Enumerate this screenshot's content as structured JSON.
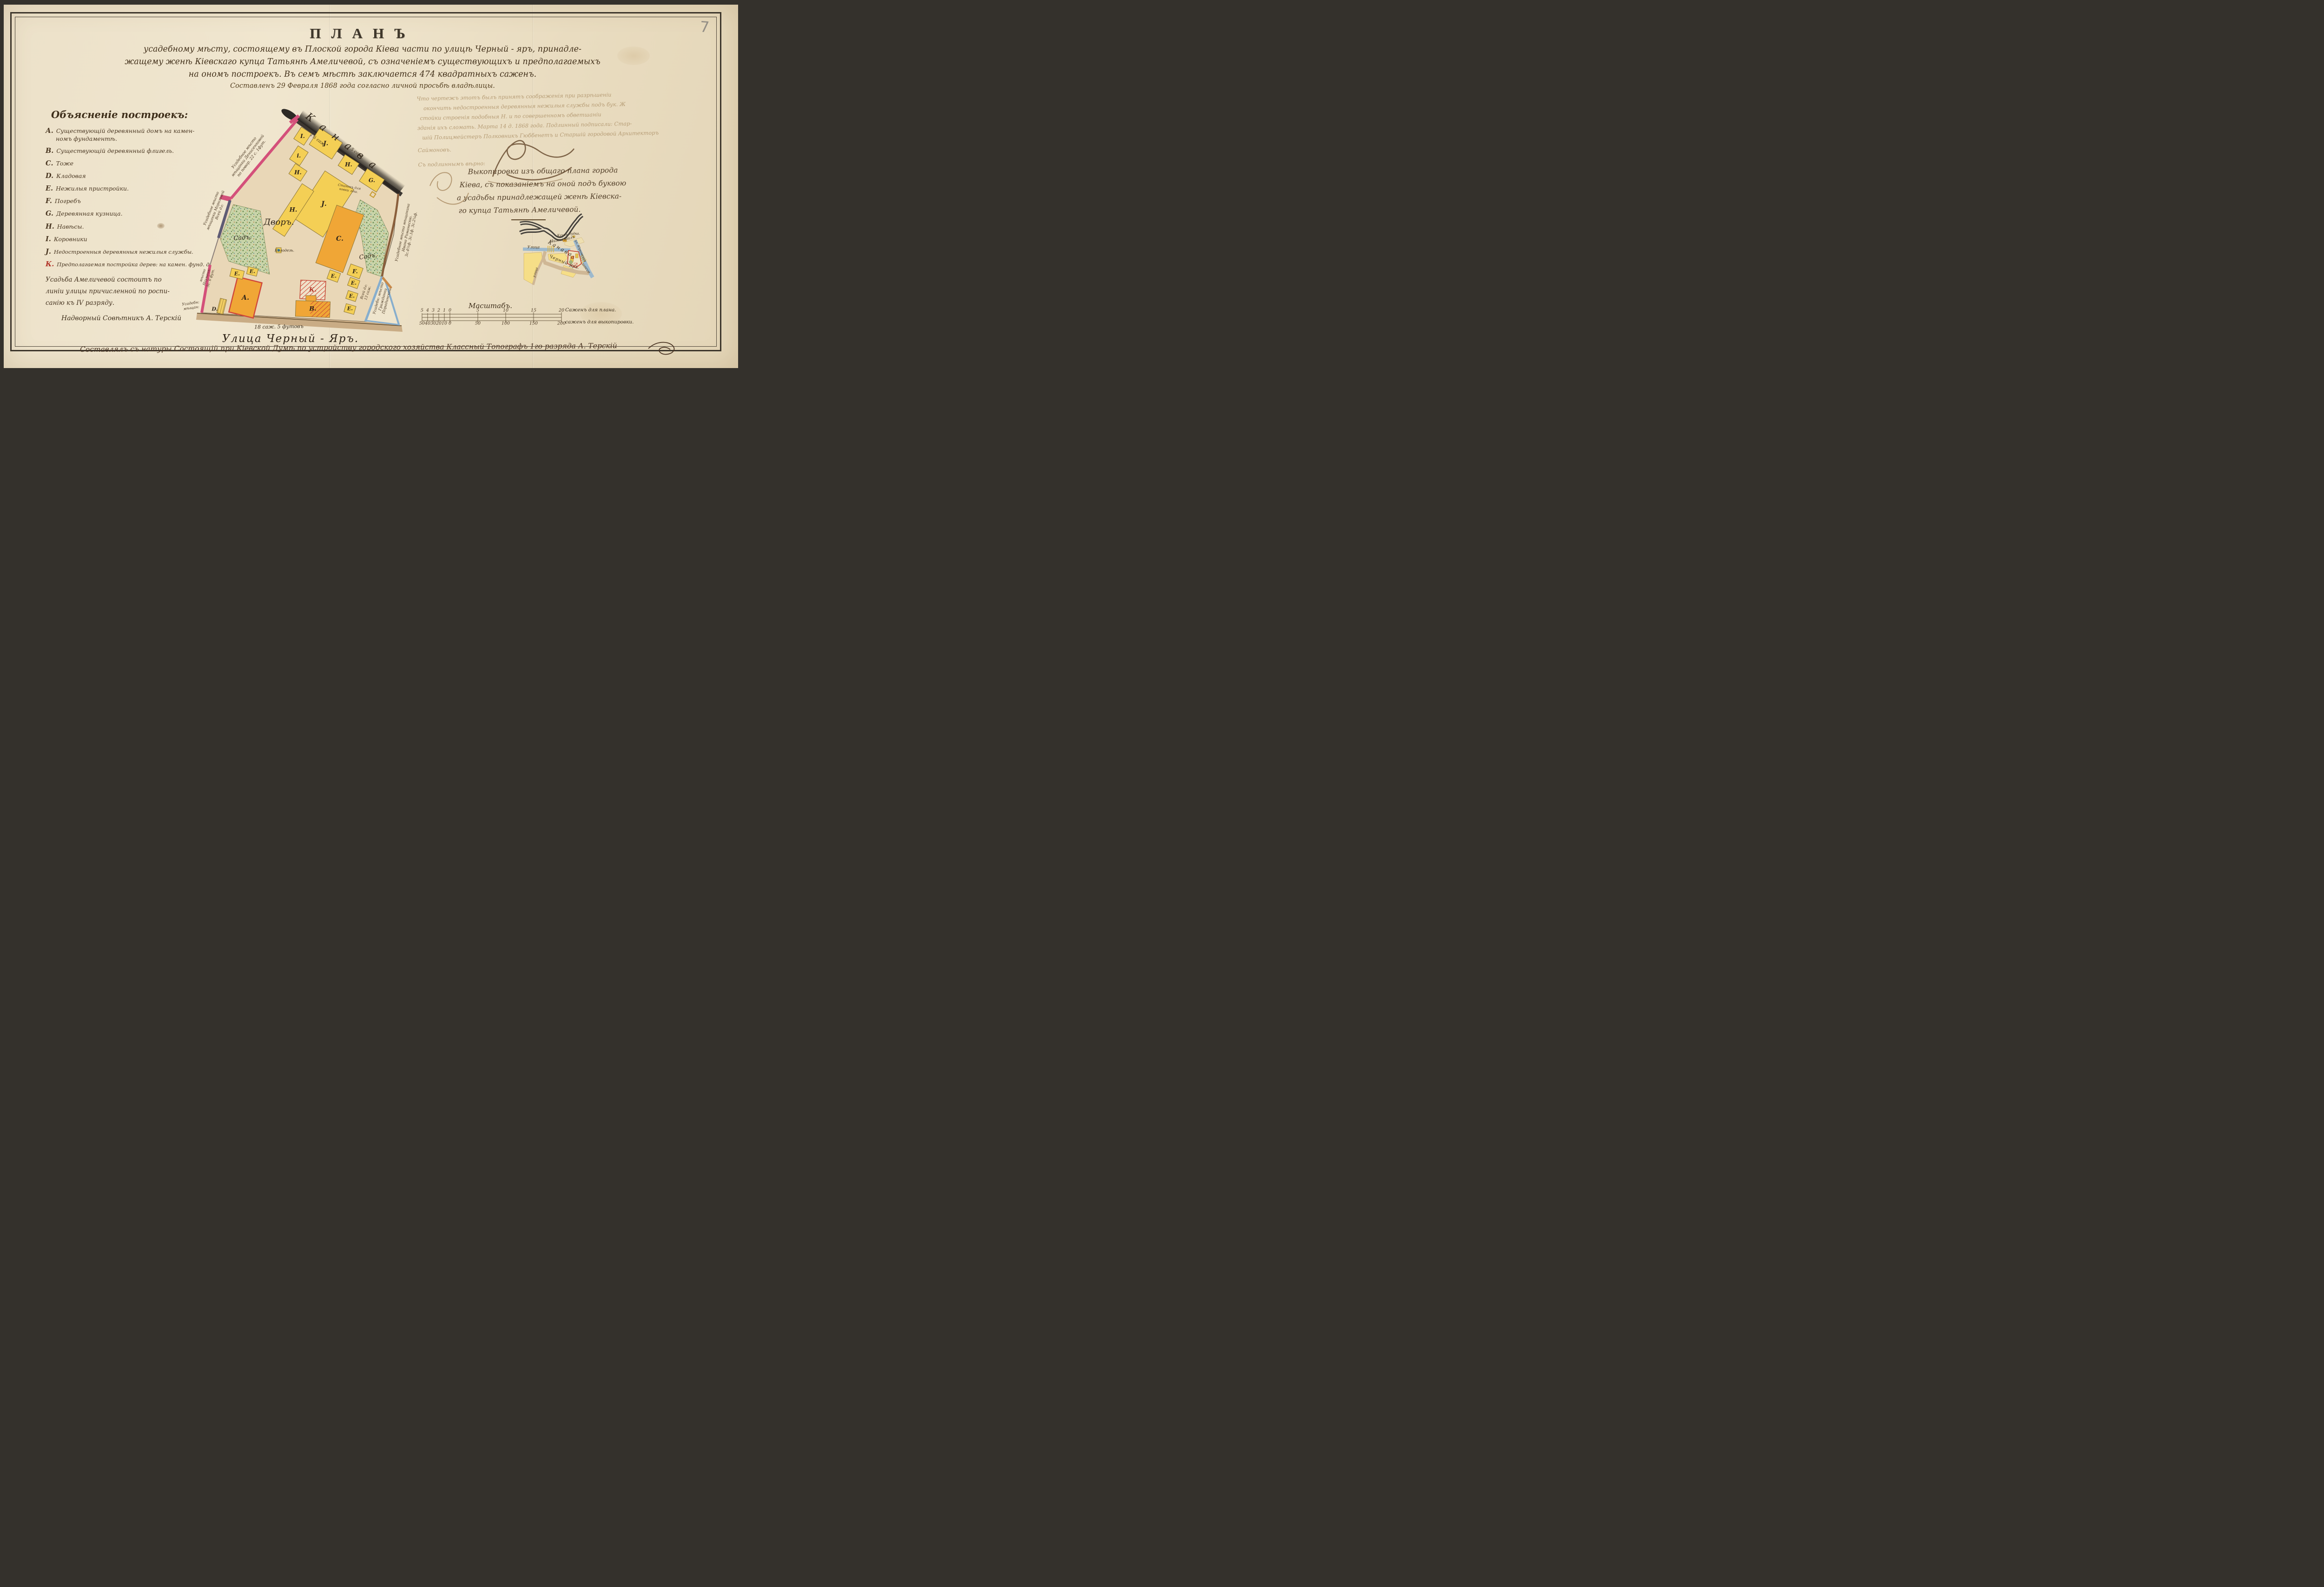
{
  "page": {
    "folio_number": "7"
  },
  "title": {
    "heading": "ПЛАНЪ",
    "line1": "усадебному мѣсту, состоящему въ Плоской города Кіева части по улицѣ Черный - яръ, принадле-",
    "line2": "жащему женѣ Кіевскаго купца Татьянѣ Амеличевой, съ означеніемъ существующихъ и предполагаемыхъ",
    "line3": "на ономъ построекъ. Въ семъ мѣстѣ заключается 474 квадратныхъ саженъ.",
    "date_line": "Составленъ 29 Февраля 1868 года согласно личной просьбѣ владѣлицы."
  },
  "legend": {
    "heading": "Объясненіе построекъ:",
    "items": [
      {
        "letter": "А.",
        "text": "Существующій деревянный домъ на камен-",
        "text2": "номъ фундаментѣ."
      },
      {
        "letter": "В.",
        "text": "Существующій деревянный флигель.",
        "text2": ""
      },
      {
        "letter": "С.",
        "text": "Тоже",
        "text2": ""
      },
      {
        "letter": "D.",
        "text": "Кладовая",
        "text2": ""
      },
      {
        "letter": "Е.",
        "text": "Нежилыя пристройки.",
        "text2": ""
      },
      {
        "letter": "F.",
        "text": "Погребъ",
        "text2": ""
      },
      {
        "letter": "G.",
        "text": "Деревянная кузница.",
        "text2": ""
      },
      {
        "letter": "Н.",
        "text": "Навѣсы.",
        "text2": ""
      },
      {
        "letter": "І.",
        "text": "Коровники",
        "text2": ""
      },
      {
        "letter": "Ј.",
        "text": "Недостроенныя деревянныя нежилыя службы.",
        "text2": ""
      },
      {
        "letter": "К.",
        "text": "Предполагаемая постройка дерев: на камен. фунд. дома",
        "text2": ""
      }
    ],
    "note_line1": "Усадьба Амеличевой состоитъ по",
    "note_line2": "линіи улицы причисленной по роспи-",
    "note_line3": "санію къ IV разряду.",
    "signature": "Надворный Совѣтникъ А. Терскій"
  },
  "certification": {
    "line1": "Что чертежъ этотъ былъ принятъ соображенія при разрѣшеніи",
    "line2": "окончить недостроенныя деревянныя нежилыя службы подъ бук. Ж",
    "line3": "стойки строенія подобныя Н. и по совершенномъ обветшаніи",
    "line4": "зданія ихъ сломать. Марта 14 д. 1868 года. Подлинный подписали: Стар-",
    "line5": "шій Полицмейстеръ Полковникъ Гюббенетъ и Старшій городовой Архитекторъ",
    "name": "Саймоновъ.",
    "attest": "Съ подлиннымъ вѣрно:"
  },
  "excerpt": {
    "line1": "Выкопировка изъ общаго плана города",
    "line2": "Кіева, съ показаніемъ на оной подъ буквою",
    "line3": "a усадьбы принадлежащей женѣ Кіевска-",
    "line4": "го купца Татьянѣ Амеличевой."
  },
  "plan": {
    "courtyard": "Дворъ.",
    "garden": "Садъ.",
    "well": "Колодезь.",
    "canal": "Канава",
    "dim_canal": "1½ саж.",
    "dim_five": "5 саж.",
    "forge_note1": "Станокъ для",
    "forge_note2": "ковки лош.",
    "frontage": "18 саж. 5 футовъ",
    "street": "Улица Черный - Яръ.",
    "letters": {
      "A": "А.",
      "B": "В.",
      "C": "С.",
      "D": "D.",
      "E": "Е.",
      "F": "F.",
      "G": "G.",
      "H": "Н.",
      "I": "І.",
      "i": "і.",
      "J": "Ј.",
      "K": "К."
    },
    "west_upper": [
      "Усадебное мѣсто",
      "мѣщанки Денисенковой",
      "по повор. 22 с. 1фут."
    ],
    "west_mid": [
      "Усадебное мѣсто",
      "мѣщанки Морозовой",
      "Всей дл:"
    ],
    "west_lower": [
      "мѣсто",
      "Науменк:",
      "5с. 6 фут."
    ],
    "corner_note": [
      "Усадебн:",
      "мѣщан:"
    ],
    "east": [
      "Усадебное мѣсто мѣщанина",
      "Ивана Романескю.",
      "3с.4½ф. 3с.1ф. 3с.2¼ф."
    ],
    "east2": [
      "Всей дл:",
      "13 саж."
    ],
    "wedge": [
      "Усадебн: мѣсто",
      "Гражданки",
      "Порадинской."
    ]
  },
  "inset": {
    "street_left": "Улица",
    "nizhniy": "Нижній",
    "val": "Валъ",
    "kitchen": "Кухня",
    "booth": "будка.",
    "canal": "Канава",
    "cherny": "Черный",
    "yar": "Яръ.",
    "shosse": "шоссе",
    "side_street": "улица",
    "right_street": "ул. Юрковская",
    "parcel_mark": "a"
  },
  "scale": {
    "title": "Масштабъ.",
    "top": [
      "5",
      "4",
      "3",
      "2",
      "1",
      "0",
      "5",
      "10",
      "15",
      "20"
    ],
    "bottom": [
      "50",
      "40",
      "30",
      "20",
      "10",
      "0",
      "50",
      "100",
      "150",
      "200"
    ],
    "top_unit": "Саженъ для плана.",
    "bottom_unit": "саженъ для выкопировки."
  },
  "footer": {
    "text": "Составлялъ съ натуры Состоящій при Кіевской Думѣ по устройству городского хозяйства Классный Топографъ 1го разряда А. Терскій"
  }
}
